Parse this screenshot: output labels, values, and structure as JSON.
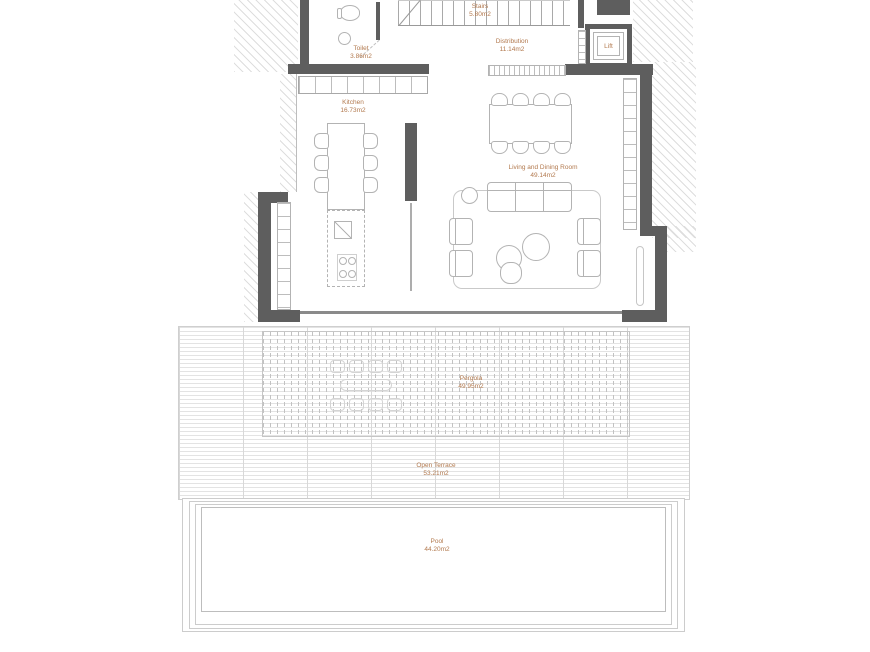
{
  "rooms": {
    "stairs": {
      "name": "Stairs",
      "area": "5.80m2"
    },
    "distribution": {
      "name": "Distribution",
      "area": "11.14m2"
    },
    "lift": {
      "name": "Lift"
    },
    "toilet": {
      "name": "Toilet",
      "area": "3.86m2"
    },
    "kitchen": {
      "name": "Kitchen",
      "area": "16.73m2"
    },
    "living_dining": {
      "name": "Living and Dining Room",
      "area": "49.14m2"
    },
    "pergola": {
      "name": "Pergola",
      "area": "49.95m2"
    },
    "open_terrace": {
      "name": "Open Terrace",
      "area": "53.21m2"
    },
    "pool": {
      "name": "Pool",
      "area": "44.20m2"
    }
  },
  "colors": {
    "wall": "#5e5e5e",
    "label_text": "#b2794e"
  }
}
